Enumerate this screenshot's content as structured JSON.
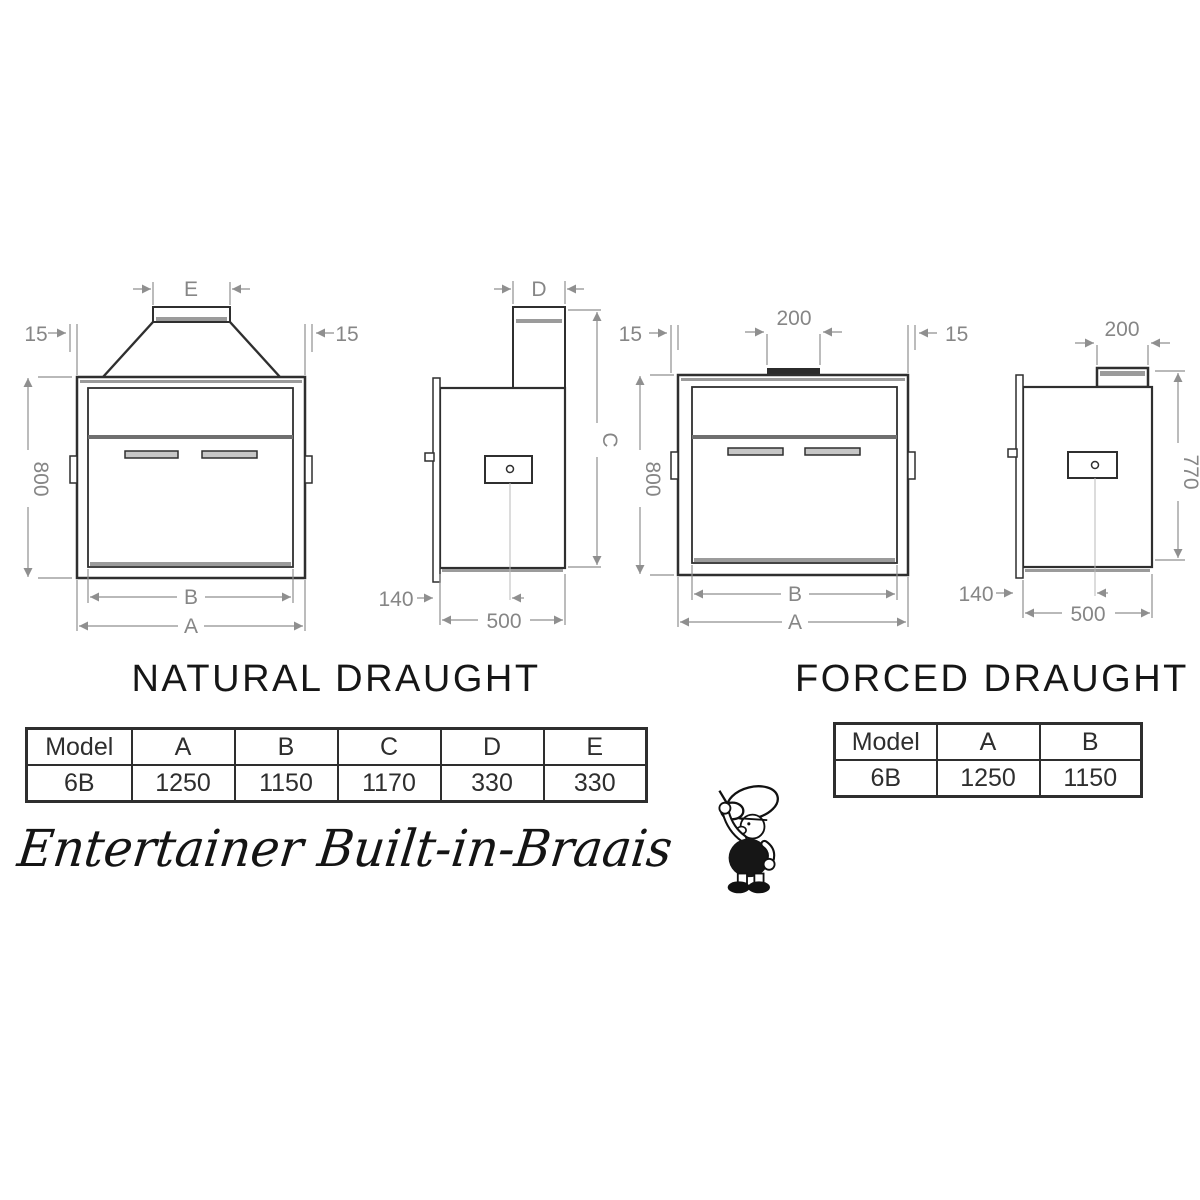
{
  "page": {
    "background": "#ffffff"
  },
  "colors": {
    "outline": "#2f2f2f",
    "dimension": "#8f8f8f",
    "band": "#9b9b9b",
    "table_border": "#2e2e2e"
  },
  "sections": {
    "natural": {
      "title": "NATURAL DRAUGHT",
      "table": {
        "headers": [
          "Model",
          "A",
          "B",
          "C",
          "D",
          "E"
        ],
        "rows": [
          [
            "6B",
            "1250",
            "1150",
            "1170",
            "330",
            "330"
          ]
        ]
      },
      "front_view": {
        "dims": {
          "hood_width": "E",
          "left_flange": "15",
          "right_flange": "15",
          "height": "800",
          "inner_width": "B",
          "overall_width": "A"
        }
      },
      "side_view": {
        "dims": {
          "flue_width": "D",
          "overall_height": "C",
          "front_offset": "140",
          "depth": "500"
        }
      }
    },
    "forced": {
      "title": "FORCED DRAUGHT",
      "table": {
        "headers": [
          "Model",
          "A",
          "B"
        ],
        "rows": [
          [
            "6B",
            "1250",
            "1150"
          ]
        ]
      },
      "front_view": {
        "dims": {
          "flue_width": "200",
          "left_flange": "15",
          "right_flange": "15",
          "height": "800",
          "inner_width": "B",
          "overall_width": "A"
        }
      },
      "side_view": {
        "dims": {
          "fan_width": "200",
          "overall_height": "770",
          "front_offset": "140",
          "depth": "500"
        }
      }
    }
  },
  "footer": {
    "slogan": "Entertainer Built-in-Braais"
  },
  "icons": {
    "mascot": "chef-mascot"
  }
}
